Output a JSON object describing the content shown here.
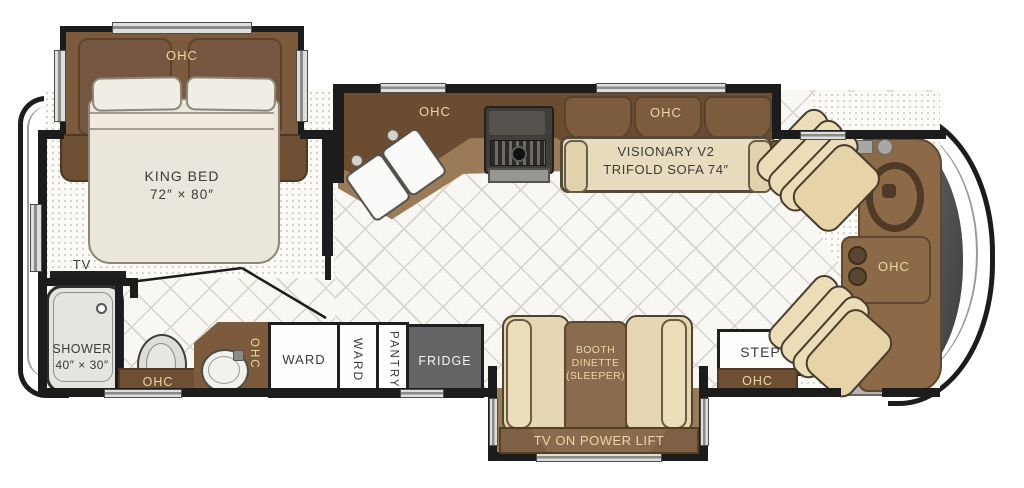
{
  "bedroom": {
    "ohc_label": "OHC",
    "bed_name": "KING BED",
    "bed_size": "72″ × 80″",
    "tv_label": "TV"
  },
  "bathroom": {
    "shower_name": "SHOWER",
    "shower_size": "40″ × 30″",
    "ohc_label": "OHC",
    "vanity_ohc_label": "OHC"
  },
  "storage": {
    "ward1_label": "WARD",
    "ward2_label": "WARD",
    "pantry_label": "PANTRY",
    "fridge_label": "FRIDGE"
  },
  "kitchen": {
    "ohc_label": "OHC"
  },
  "living": {
    "ohc_label": "OHC",
    "sofa_name": "VISIONARY V2",
    "sofa_type": "TRIFOLD SOFA 74″"
  },
  "dinette": {
    "line1": "BOOTH",
    "line2": "DINETTE",
    "line3": "(SLEEPER)",
    "tv_lift_label": "TV ON POWER LIFT"
  },
  "entry": {
    "step_label": "STEP",
    "ohc_label": "OHC"
  },
  "cockpit": {
    "ohc_label": "OHC"
  },
  "colors": {
    "wall": "#1c1c1c",
    "cabinet_dark": "#6e4f34",
    "cabinet_mid": "#9b7b57",
    "upholstery_cream": "#e7dcbe",
    "label_cream": "#e9d6a7",
    "fridge_gray": "#646467",
    "floor_tile": "#f8f7f3",
    "carpet": "#fbfaf6"
  }
}
